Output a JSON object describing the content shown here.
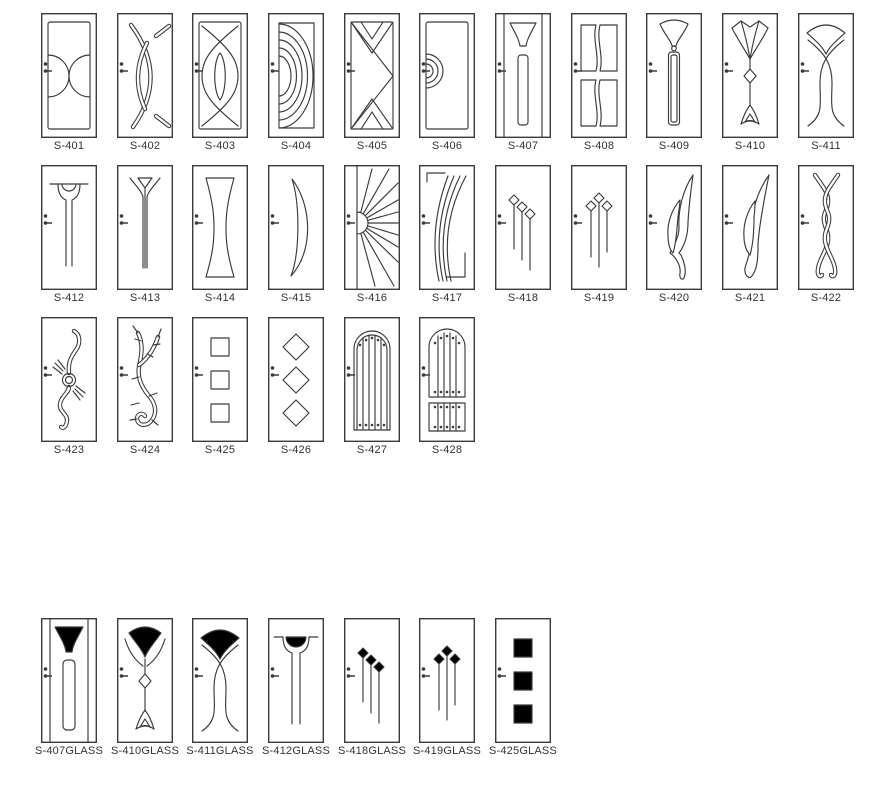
{
  "page": {
    "background": "#ffffff",
    "line_color": "#3b3b3b",
    "label_color": "#333333",
    "glass_color": "#6fa8dc"
  },
  "icons": {
    "door_handle": "door-handle-icon"
  },
  "catalog": {
    "rows": [
      {
        "items": [
          {
            "label": "S-401",
            "design": "s401"
          },
          {
            "label": "S-402",
            "design": "s402"
          },
          {
            "label": "S-403",
            "design": "s403"
          },
          {
            "label": "S-404",
            "design": "s404"
          },
          {
            "label": "S-405",
            "design": "s405"
          },
          {
            "label": "S-406",
            "design": "s406"
          },
          {
            "label": "S-407",
            "design": "s407"
          },
          {
            "label": "S-408",
            "design": "s408"
          },
          {
            "label": "S-409",
            "design": "s409"
          },
          {
            "label": "S-410",
            "design": "s410"
          },
          {
            "label": "S-411",
            "design": "s411"
          }
        ]
      },
      {
        "items": [
          {
            "label": "S-412",
            "design": "s412"
          },
          {
            "label": "S-413",
            "design": "s413"
          },
          {
            "label": "S-414",
            "design": "s414"
          },
          {
            "label": "S-415",
            "design": "s415"
          },
          {
            "label": "S-416",
            "design": "s416"
          },
          {
            "label": "S-417",
            "design": "s417"
          },
          {
            "label": "S-418",
            "design": "s418"
          },
          {
            "label": "S-419",
            "design": "s419"
          },
          {
            "label": "S-420",
            "design": "s420"
          },
          {
            "label": "S-421",
            "design": "s421"
          },
          {
            "label": "S-422",
            "design": "s422"
          }
        ]
      },
      {
        "items": [
          {
            "label": "S-423",
            "design": "s423"
          },
          {
            "label": "S-424",
            "design": "s424"
          },
          {
            "label": "S-425",
            "design": "s425"
          },
          {
            "label": "S-426",
            "design": "s426"
          },
          {
            "label": "S-427",
            "design": "s427"
          },
          {
            "label": "S-428",
            "design": "s428"
          }
        ]
      },
      {
        "items": [
          {
            "label": "S-407GLASS",
            "design": "g407"
          },
          {
            "label": "S-410GLASS",
            "design": "g410"
          },
          {
            "label": "S-411GLASS",
            "design": "g411"
          },
          {
            "label": "S-412GLASS",
            "design": "g412"
          },
          {
            "label": "S-418GLASS",
            "design": "g418"
          },
          {
            "label": "S-419GLASS",
            "design": "g419"
          },
          {
            "label": "S-425GLASS",
            "design": "g425"
          }
        ]
      }
    ]
  }
}
